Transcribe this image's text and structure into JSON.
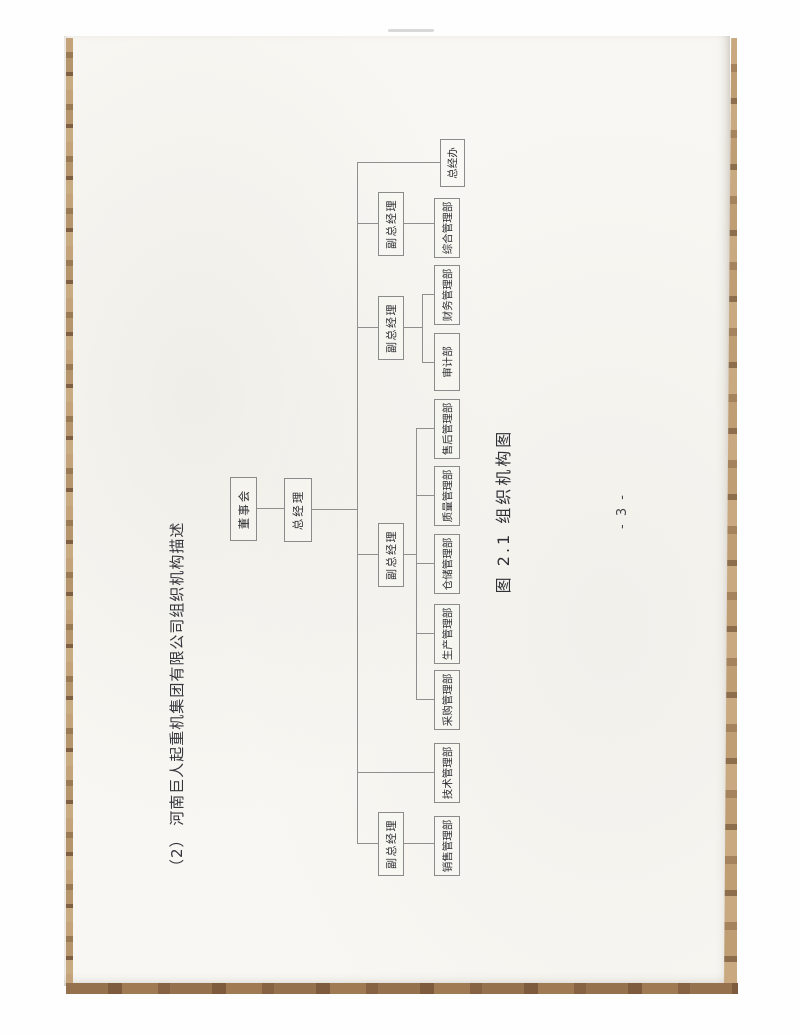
{
  "document": {
    "section_title": "（2） 河南巨人起重机集团有限公司组织机构描述",
    "figure_caption": "图 2.1  组织机构图",
    "page_number": "- 3 -"
  },
  "org_chart": {
    "type": "org-tree",
    "board": "董事会",
    "general_manager": "总经理",
    "deputies": [
      {
        "label": "副总经理",
        "departments": [
          "销售管理部"
        ]
      },
      {
        "label": "副总经理",
        "departments": [
          "采购管理部",
          "生产管理部",
          "仓储管理部",
          "质量管理部",
          "售后管理部"
        ]
      },
      {
        "label": "副总经理",
        "departments": [
          "审计部",
          "财务管理部"
        ]
      },
      {
        "label": "副总经理",
        "departments": [
          "综合管理部"
        ]
      }
    ],
    "direct_departments": [
      "技术管理部",
      "总经办"
    ]
  },
  "colors": {
    "paper": "#f8f7f3",
    "connector_line": "#8f8f8f",
    "ink": "#2e2f33",
    "wood_edge": "#a07a53"
  }
}
